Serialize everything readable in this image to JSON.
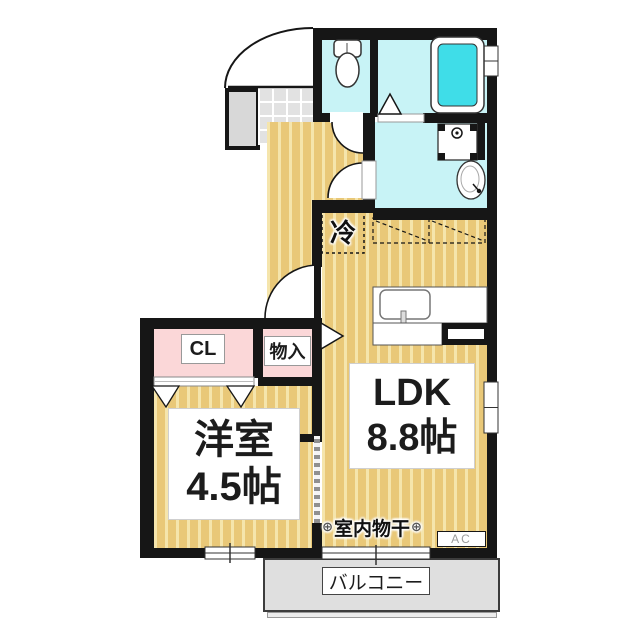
{
  "title": "1LDK apartment floor plan",
  "rooms": {
    "ldk": {
      "name": "LDK",
      "size": "8.8帖"
    },
    "western_room": {
      "name": "洋室",
      "size": "4.5帖"
    },
    "closet": "CL",
    "storage": "物入",
    "refrigerator": "冷",
    "indoor_drying": "室内物干",
    "drying_marker": "⊕",
    "air_conditioner": "AC",
    "balcony": "バルコニー"
  },
  "fixtures": {
    "toilet": "toilet-icon",
    "bathtub": "bathtub-icon",
    "washing_machine_pan": "washing-machine-pan-icon",
    "wash_basin": "wash-basin-icon",
    "kitchen_sink": "kitchen-sink-icon",
    "entrance_door": "entrance-door-arc",
    "range_hood_cabinet": "overhead-cabinet-dashed"
  },
  "colors": {
    "wall": "#161616",
    "floor_tan": "#e9c878",
    "floor_stripe": "#f5e5ac",
    "water": "#c8f3f6",
    "tub": "#3fdde8",
    "pink": "#fbd7d8",
    "tile": "#e2e2e2",
    "porch": "#d8d8d8",
    "balcony": "#dfdfdf"
  }
}
